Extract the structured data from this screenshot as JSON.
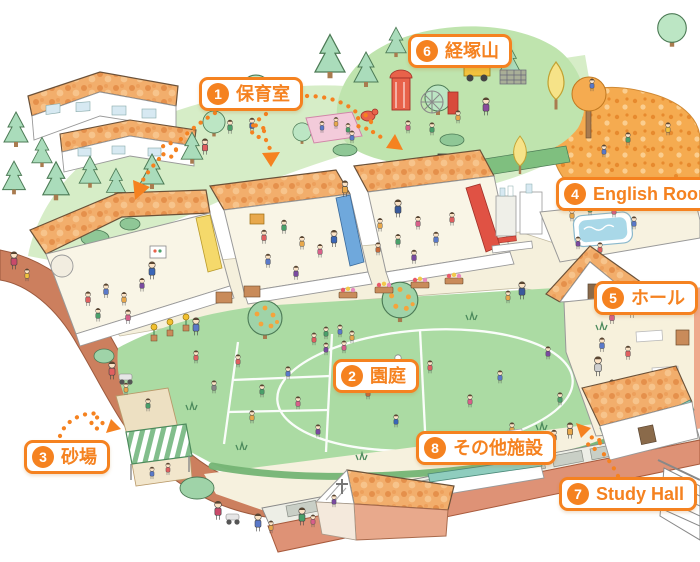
{
  "map": {
    "labels": [
      {
        "number": "1",
        "text": "保育室"
      },
      {
        "number": "2",
        "text": "園庭"
      },
      {
        "number": "3",
        "text": "砂場"
      },
      {
        "number": "4",
        "text": "English Room"
      },
      {
        "number": "5",
        "text": "ホール"
      },
      {
        "number": "6",
        "text": "経塚山"
      },
      {
        "number": "7",
        "text": "Study Hall"
      },
      {
        "number": "8",
        "text": "その他施設"
      }
    ],
    "palette": {
      "accent": "#F58220",
      "roof_orange": "#F2AE6C",
      "lawn_green": "#D6EDC7",
      "hill_green": "#BFE4AE",
      "field_green": "#ABDBA3",
      "path_terracotta": "#CC7F5E",
      "wall_salmon": "#DE9276",
      "pool_blue": "#A9D8E8"
    }
  }
}
